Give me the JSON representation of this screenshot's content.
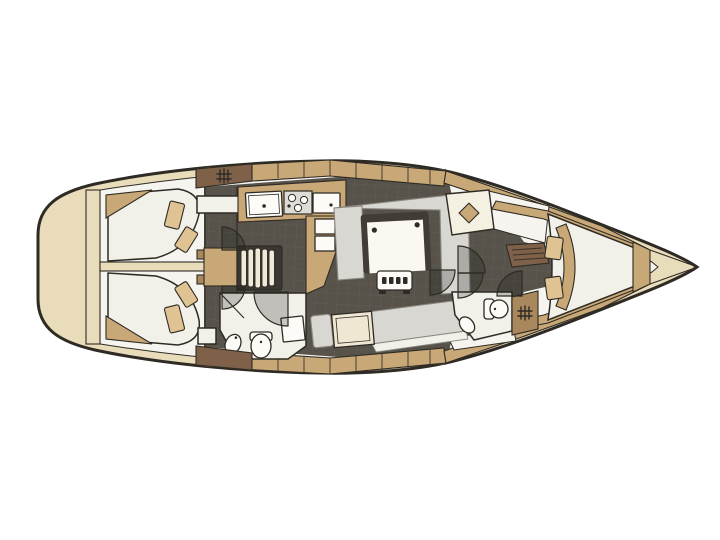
{
  "diagram": {
    "type": "yacht-interior-floor-plan",
    "orientation": "bow-right-stern-left",
    "canvas": {
      "width": 720,
      "height": 540,
      "background": "#ffffff"
    }
  },
  "palette": {
    "line": "#2e2a24",
    "hull": "#e9dcba",
    "deck": "#f5f4ef",
    "wood": "#c9a877",
    "woodMid": "#a9885e",
    "woodDark": "#7e6148",
    "floor": "#57534b",
    "floorGrid": "#6a665d",
    "room": "#f1f0e9",
    "cushion": "#d8d7d2",
    "pillow": "#dfc392",
    "fixture": "#fcfbf7",
    "tableBorder": "#413d36",
    "tread": "#f0e9d7",
    "stepBase": "#3b3833",
    "navDesk": "#efe7d2",
    "stove": "#dddcd6",
    "tableTop": "#faf8f1"
  },
  "features": {
    "stern_deck": "rounded transom platform",
    "aft_cabin_port": "double berth with two pillows",
    "aft_cabin_starboard": "double berth with two pillows",
    "companionway_steps": "five curved treads",
    "galley": "double sink, three-burner stove, second sink, fridge boxes, L counter",
    "saloon": "U-settee around folding table, slatted stool",
    "nav_station": "chart desk with seat",
    "aft_head": "toilet, basin, shower seat",
    "forward_head": "toilet, basin",
    "wardrobe": "hanging locker with diamond symbol",
    "shelf_locker": "slatted shelf unit",
    "forward_cabin": "V-berth with two pillows",
    "bow_locker": "anchor locker bulkhead"
  }
}
